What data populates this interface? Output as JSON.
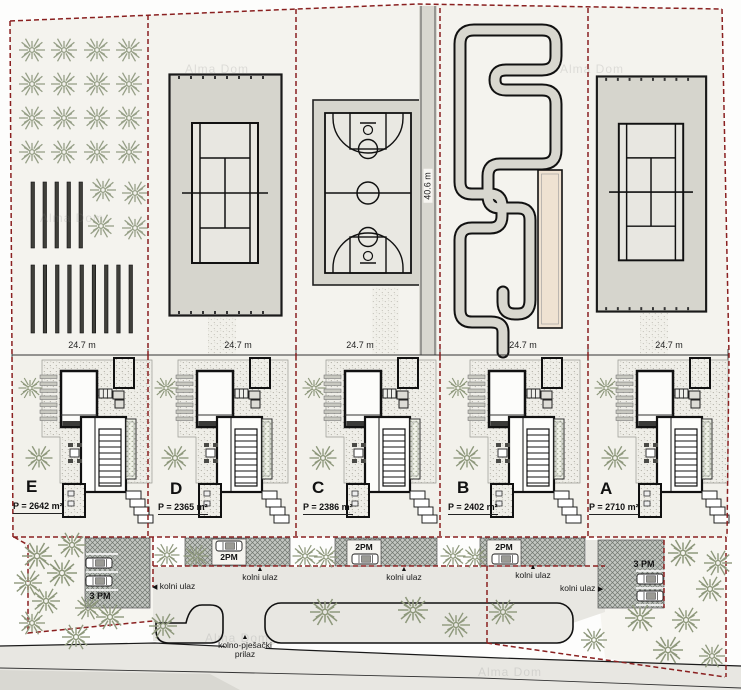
{
  "site": {
    "watermark": "Alma Dom",
    "depth": "40.6 m",
    "access_arrow": "▲",
    "access_line1": "kolno-pješački",
    "access_line2": "prilaz"
  },
  "plots": [
    {
      "label": "E",
      "area": "P = 2642 m²",
      "width": "24.7 m",
      "amenity": "orchard",
      "parking": "3 PM",
      "entrance_label": "kolni ulaz",
      "entrance_arrow": "◀"
    },
    {
      "label": "D",
      "area": "P = 2365 m²",
      "width": "24.7 m",
      "amenity": "tennis-court",
      "parking": "2PM",
      "entrance_label": "kolni ulaz",
      "entrance_arrow": "▲"
    },
    {
      "label": "C",
      "area": "P = 2386 m²",
      "width": "24.7 m",
      "amenity": "basketball-court",
      "parking": "2PM",
      "entrance_label": "kolni ulaz",
      "entrance_arrow": "▲"
    },
    {
      "label": "B",
      "area": "P = 2402 m²",
      "width": "24.7 m",
      "amenity": "go-kart-track",
      "parking": "2PM",
      "entrance_label": "kolni ulaz",
      "entrance_arrow": "▲"
    },
    {
      "label": "A",
      "area": "P = 2710 m²",
      "width": "24.7 m",
      "amenity": "tennis-court",
      "parking": "3 PM",
      "entrance_label": "kolni ulaz",
      "entrance_arrow": "▶"
    }
  ],
  "colors": {
    "boundary": "#8a2020",
    "road": "#e8e7e2",
    "court": "#d6d5cd",
    "tree": "#8e987c",
    "track_tan": "#efe2d2"
  }
}
